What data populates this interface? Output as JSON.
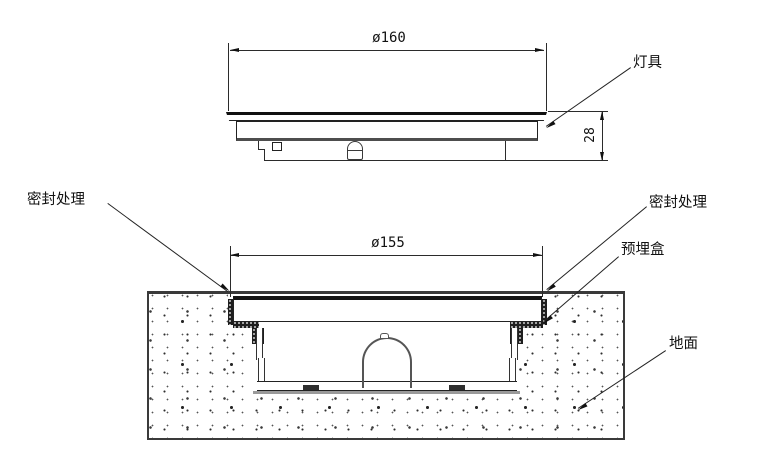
{
  "drawing": {
    "type": "installation-cross-section",
    "dimensions": {
      "fixture_diameter": "ø160",
      "fixture_height": "28",
      "box_diameter": "ø155"
    },
    "annotations": {
      "fixture": "灯具",
      "seal_left": "密封处理",
      "seal_right": "密封处理",
      "embedded_box": "预埋盒",
      "ground": "地面"
    },
    "colors": {
      "line": "#2b2b2b",
      "dark": "#111111",
      "shadow_gray": "#9a9a9a",
      "background": "#ffffff"
    }
  }
}
